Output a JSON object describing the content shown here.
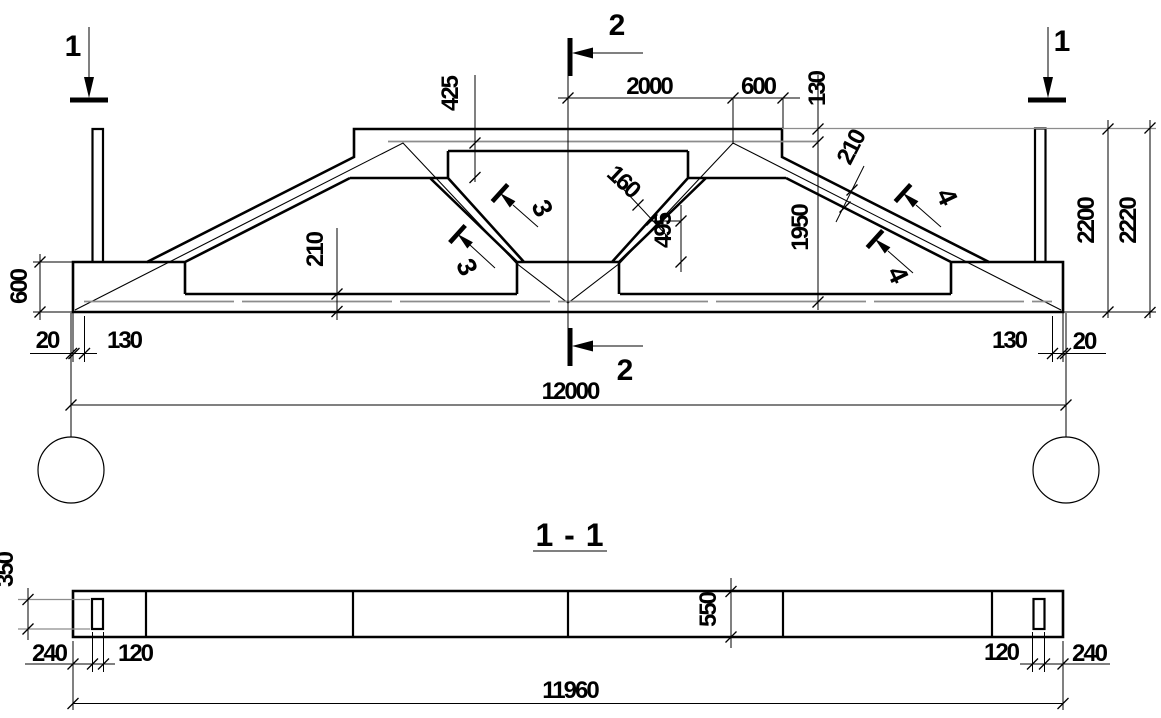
{
  "drawing": {
    "kind": "structural girder elevation with section",
    "colors": {
      "line": "#000000",
      "reinforcement_gray": "#8c8c8c",
      "background": "#ffffff"
    },
    "elevation": {
      "section_marker_1": "1",
      "section_marker_2": "2",
      "section_marker_3": "3",
      "section_marker_4": "4",
      "dims": {
        "top_2000": "2000",
        "top_600": "600",
        "cover_130": "130",
        "left_425": "425",
        "diag_160": "160",
        "mid_495": "495",
        "right_1950": "1950",
        "slope_210": "210",
        "chord_210": "210",
        "end_height_600": "600",
        "left_20": "20",
        "left_130": "130",
        "right_130": "130",
        "right_20": "20",
        "span_12000": "12000",
        "height_2200": "2200",
        "height_2220": "2220"
      }
    },
    "section_1_1": {
      "title": "1 - 1",
      "dims": {
        "d350": "350",
        "left_240": "240",
        "left_120": "120",
        "width_550": "550",
        "right_120": "120",
        "right_240": "240",
        "length_11960": "11960"
      }
    }
  }
}
